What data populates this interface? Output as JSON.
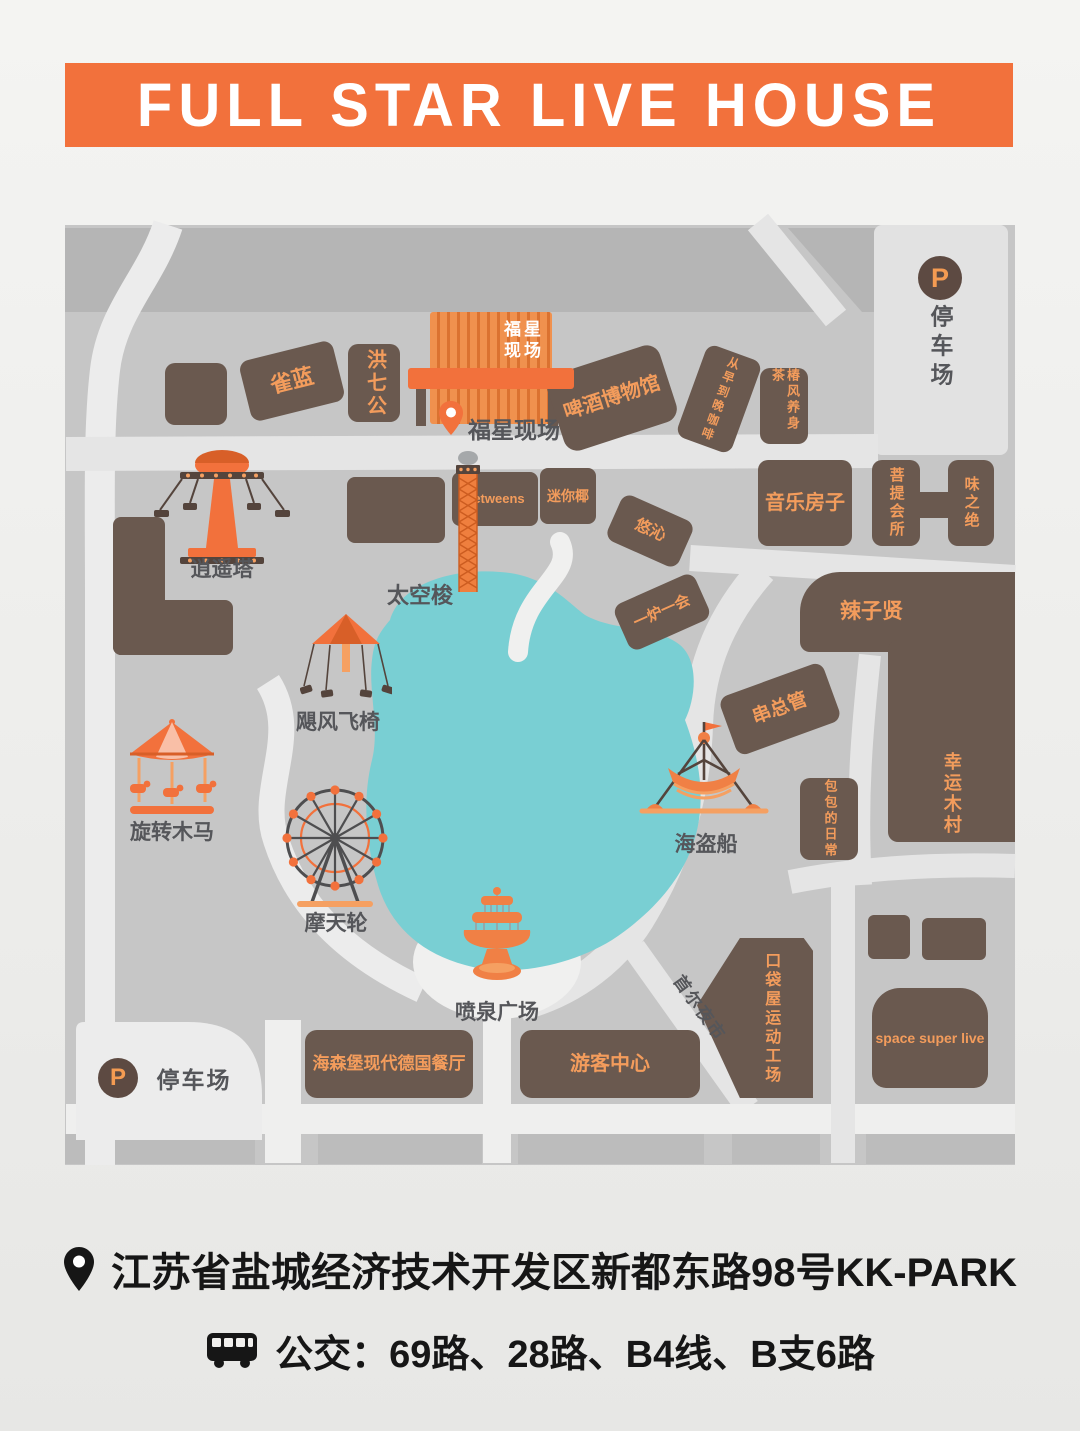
{
  "header": {
    "title": "FULL STAR LIVE HOUSE"
  },
  "map": {
    "parking_top": {
      "symbol": "P",
      "label": "停车场"
    },
    "parking_bottom": {
      "symbol": "P",
      "label": "停车场"
    },
    "stage": {
      "sign_line1": "福星",
      "sign_line2": "现场",
      "pin_label": "福星现场"
    },
    "buildings": {
      "quelan": "雀蓝",
      "hongqigong": "洪七公",
      "beer_museum": "啤酒博物馆",
      "cafe": "从早到晚咖啡",
      "chunfeng_tea": "椿风养身茶",
      "music_house": "音乐房子",
      "puti_club": "菩提会所",
      "weizhijue": "味之绝",
      "lazixian": "辣子贤",
      "betweens": "betweens",
      "mini_coconut": "迷你椰",
      "youqin": "悠沁",
      "yiluyihui": "一炉一会",
      "chuanzongguan": "串总管",
      "baobao_daily": "包包的日常",
      "lucky_wood_village": "幸运木村",
      "pocket_sports": "口袋屋运动工场",
      "space_super_live": "space super live",
      "heisenberg_restaurant": "海森堡现代德国餐厅",
      "visitor_center": "游客中心"
    },
    "rides": {
      "xiaoyao_tower": "逍遥塔",
      "space_shuttle": "太空梭",
      "hurricane_chairs": "飓风飞椅",
      "carousel": "旋转木马",
      "ferris_wheel": "摩天轮",
      "pirate_ship": "海盗船",
      "fountain_plaza": "喷泉广场"
    },
    "roads": {
      "seoul_night_market": "首尔夜市"
    }
  },
  "footer": {
    "address": "江苏省盐城经济技术开发区新都东路98号KK-PARK",
    "bus_routes": "公交：69路、28路、B4线、B支6路"
  },
  "colors": {
    "accent_orange": "#f2713c",
    "building_brown": "#6a594f",
    "label_orange": "#f39c5c",
    "lake_teal": "#79cfd3",
    "map_gray": "#c6c6c6",
    "block_gray": "#b5b5b5",
    "road_light": "#e5e5e5",
    "text_gray": "#55565a"
  }
}
